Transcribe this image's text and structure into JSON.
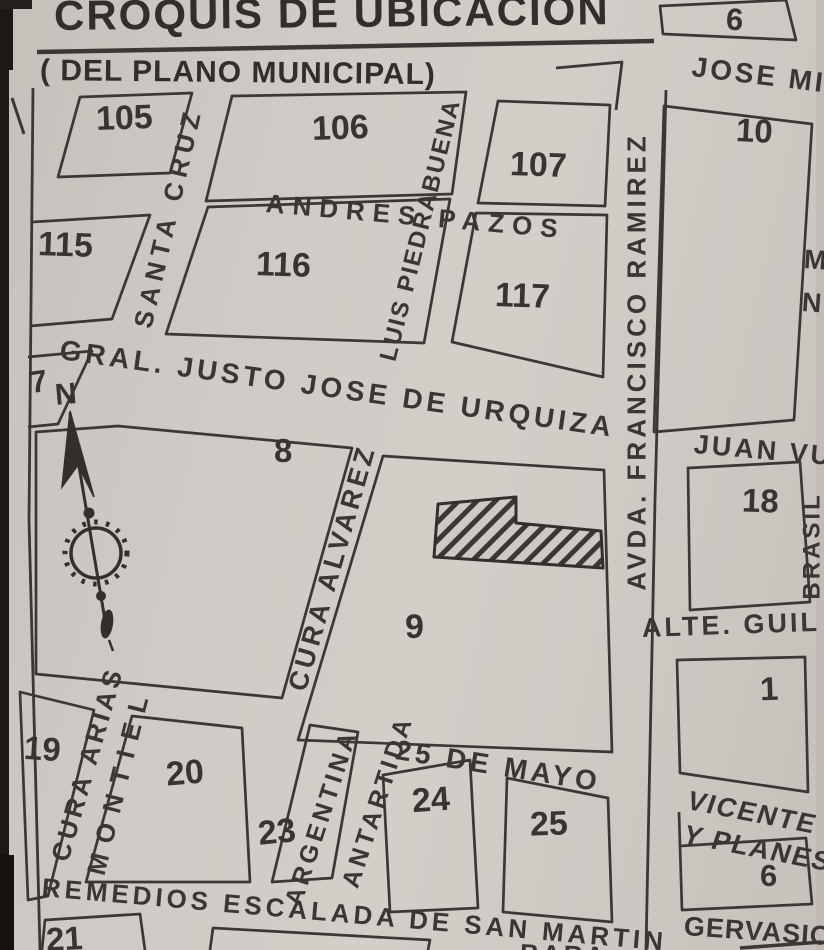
{
  "document": {
    "title": "CROQUIS DE UBICACIÓN",
    "subtitle": "( DEL PLANO MUNICIPAL)"
  },
  "compass": {
    "north": "N"
  },
  "blocks": {
    "b105": "105",
    "b106": "106",
    "b107": "107",
    "b115": "115",
    "b116": "116",
    "b117": "117",
    "b7": "7",
    "b8": "8",
    "b9": "9",
    "b19": "19",
    "b20": "20",
    "b23": "23",
    "b24": "24",
    "b25": "25",
    "b21": "21",
    "r6_top": "6",
    "r10": "10",
    "r18": "18",
    "r1": "1",
    "r6_bottom": "6"
  },
  "streets": {
    "santa_cruz": "SANTA CRUZ",
    "andres_pazos": "ANDRES PAZOS",
    "luis_piedrabuena": "LUIS PIEDRABUENA",
    "urquiza": "GRAL. JUSTO JOSE DE URQUIZA",
    "cura_alvarez": "CURA ALVAREZ",
    "mayo25": "25 DE MAYO",
    "cura_arias": "CURA ARIAS",
    "montiel": "MONTIEL",
    "antartida": "ANTARTIDA",
    "argentina": "ARGENTINA",
    "remedios": "REMEDIOS ESCALADA DE SAN MARTIN",
    "ramirez": "AVDA. FRANCISCO RAMIREZ",
    "jose_mi": "JOSE MI",
    "juan_vu": "JUAN VU",
    "brasil": "BRASIL",
    "alte_guil": "ALTE.  GUIL",
    "vicente": "VICENTE",
    "y_planes": "Y PLANES",
    "gervasio": "GERVASIO"
  },
  "partials": {
    "edge_m": "M",
    "edge_n": "N",
    "bottom_cut": "BARA"
  },
  "colors": {
    "paper": "#d0cac6",
    "ink": "#3b3733",
    "scan_edge": "#1b1815"
  }
}
